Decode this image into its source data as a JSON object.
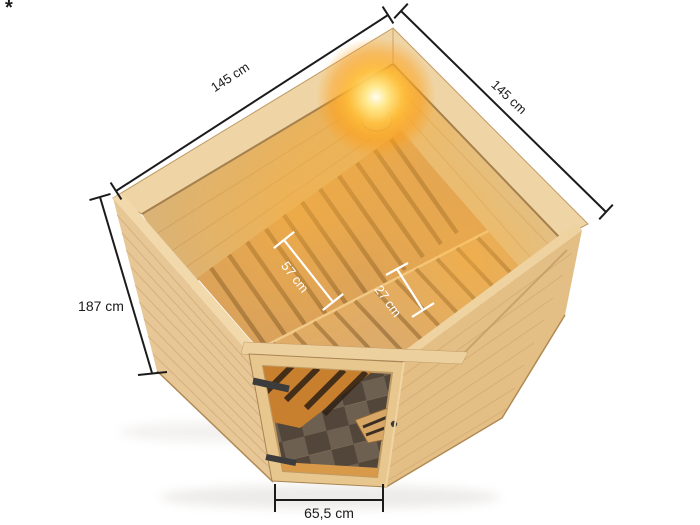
{
  "annotation": {
    "footnote_marker": "*"
  },
  "dimensions": {
    "top_left_edge": "145 cm",
    "top_right_edge": "145 cm",
    "left_height": "187 cm",
    "bench_main_depth": "57 cm",
    "bench_step_depth": "27 cm",
    "door_width": "65,5 cm"
  },
  "illustration": {
    "subject": "corner sauna top view with open roof, interior benches, corner light and glazed corner-entry door",
    "colors": {
      "background": "#ffffff",
      "wood_light": "#efd5a6",
      "wood_mid": "#e3bf86",
      "bench_slat": "#d6a05f",
      "glow_accent": "#ff9c12",
      "glass_dark": "#52463b",
      "dimension_line_dark": "#1a1a1a",
      "dimension_line_light": "#ffffff"
    }
  }
}
